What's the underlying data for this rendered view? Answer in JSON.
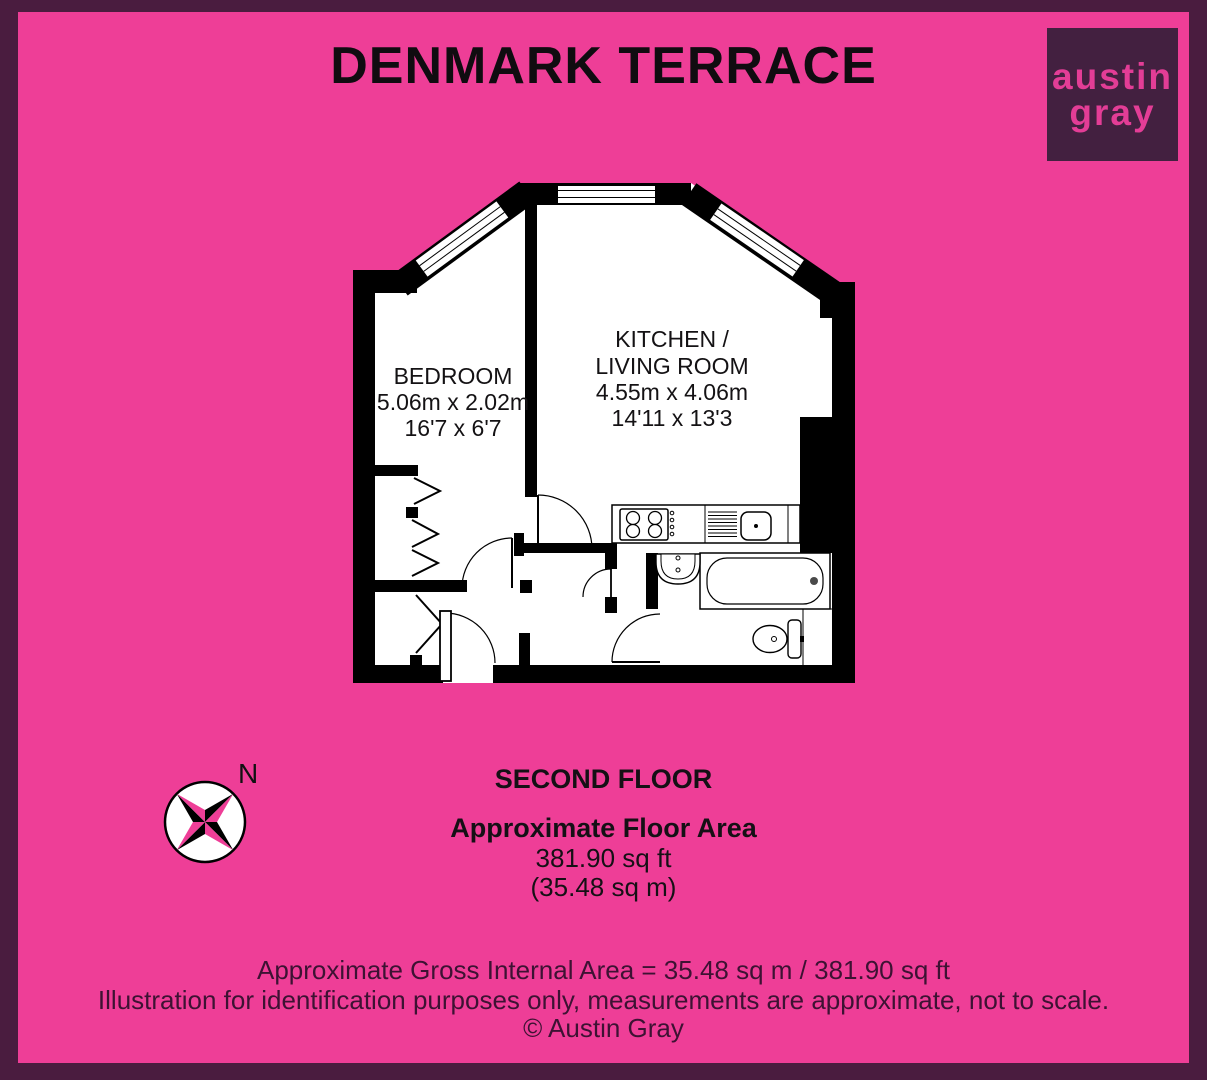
{
  "title": "DENMARK TERRACE",
  "logo": {
    "word1": "austin",
    "word2": "gray"
  },
  "plan": {
    "bedroom": {
      "name": "BEDROOM",
      "size_metric": "5.06m x 2.02m",
      "size_imperial": "16'7 x 6'7"
    },
    "kitchen": {
      "name_line1": "KITCHEN /",
      "name_line2": "LIVING ROOM",
      "size_metric": "4.55m x 4.06m",
      "size_imperial": "14'11 x 13'3"
    }
  },
  "compass": {
    "north_label": "N"
  },
  "summary": {
    "floor": "SECOND FLOOR",
    "area_heading": "Approximate Floor Area",
    "area_sqft": "381.90 sq ft",
    "area_sqm": "(35.48 sq m)"
  },
  "footer": {
    "line1": "Approximate Gross Internal Area = 35.48 sq m / 381.90 sq ft",
    "line2": "Illustration for identification purposes only, measurements are approximate, not to scale.",
    "line3": "© Austin Gray"
  },
  "colors": {
    "background": "#EE3E97",
    "frame": "#4A1C3F",
    "logo_box": "#432040",
    "logo_text": "#E33D96",
    "plan_walls": "#000000",
    "footer_text": "#3D1233"
  }
}
